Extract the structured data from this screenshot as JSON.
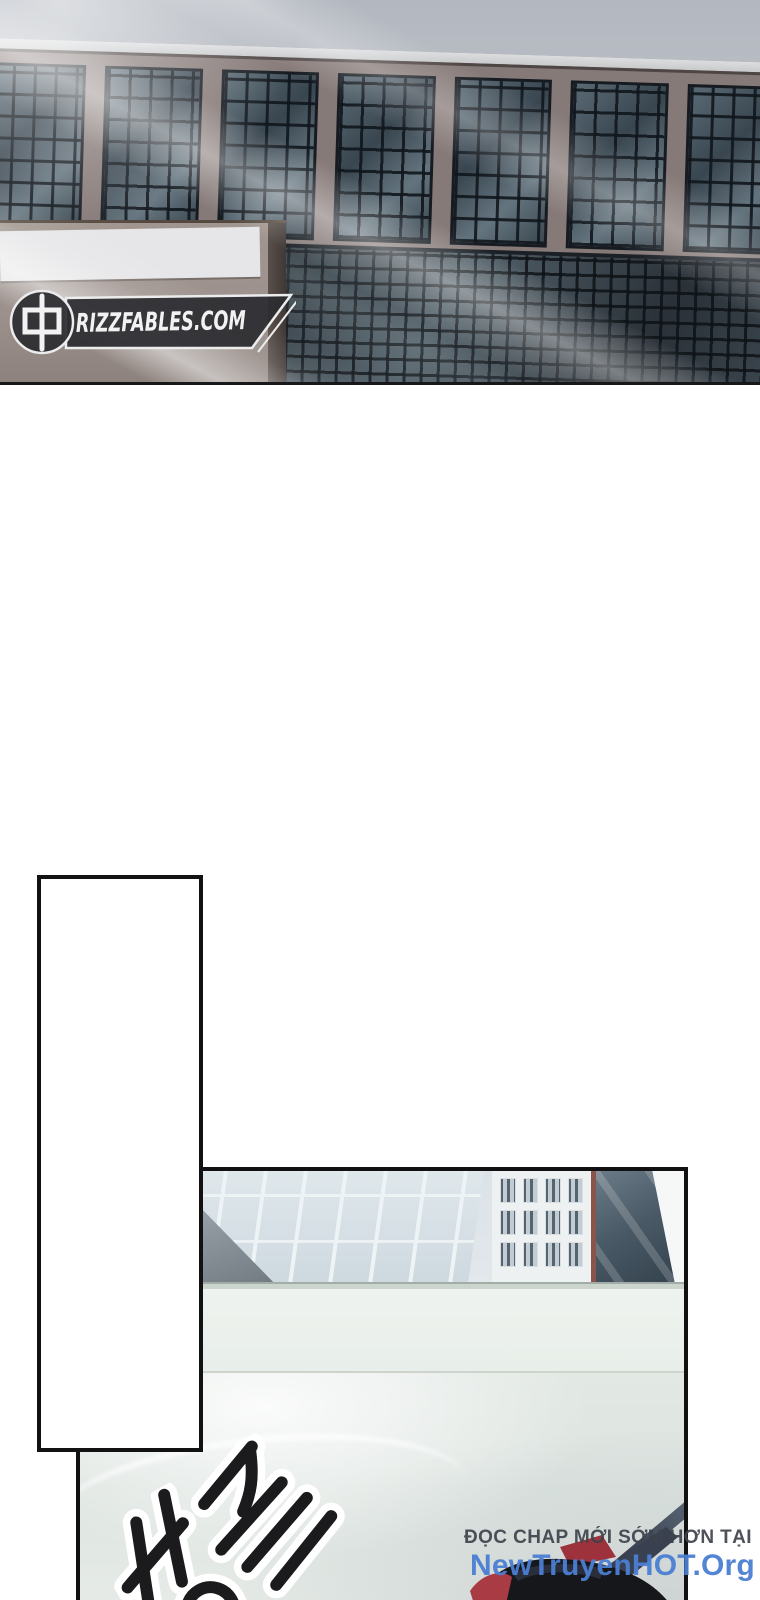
{
  "watermark": {
    "symbol": "中",
    "site": "RIZZFABLES.COM",
    "badge_fill": "#2d2d30",
    "outline_color": "#ececec"
  },
  "promo": {
    "line1": "ĐỌC CHAP MỚI SỚM HƠN TẠI",
    "line1_color": "#3f434b",
    "line2": "NewTruyenHOT.Org",
    "line2_color": "#4b7fd3"
  },
  "sfx": {
    "text": "빙글",
    "style": "hand-drawn black strokes with white outline, rotated"
  },
  "palette": {
    "page_bg": "#ffffff",
    "panel_border": "#121212",
    "sky_top_panel": "#b3b8c0",
    "building_facade": "#867a78",
    "window_glass": "#4a5a66",
    "front_building": "#9c918d",
    "banner": "#e6e6e8",
    "rooftop_panel_bg": "#e9efec",
    "rooftop_sky": "#dce3e8",
    "accent_red": "#a83b44"
  }
}
